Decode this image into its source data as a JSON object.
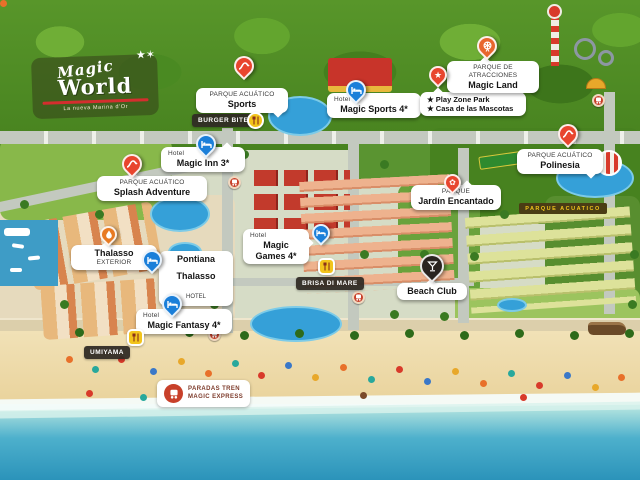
{
  "logo": {
    "name_top": "Magic",
    "name_bottom": "World",
    "tagline": "La nueva Marina d'Or",
    "stars": "★✶"
  },
  "markers": {
    "sports": {
      "category": "PARQUE ACUÁTICO",
      "name": "Sports"
    },
    "magic_sports": {
      "category": "Hotel",
      "name": "Magic Sports 4*"
    },
    "play_zone": {
      "line1": "★ Play Zone Park",
      "line2": "★ Casa de las Mascotas"
    },
    "magic_land": {
      "category": "PARQUE DE ATRACCIONES",
      "name": "Magic Land"
    },
    "burger_bites": {
      "name": "BURGER BITES"
    },
    "magic_inn": {
      "category": "Hotel",
      "name": "Magic Inn 3*"
    },
    "splash_adventure": {
      "category": "PARQUE ACUÁTICO",
      "name": "Splash Adventure"
    },
    "polinesia": {
      "category": "PARQUE ACUÁTICO",
      "name": "Polinesia"
    },
    "jardin_encantado": {
      "category": "PARQUE",
      "name": "Jardín Encantado"
    },
    "magic_games": {
      "category": "Hotel",
      "name": "Magic Games 4*"
    },
    "thalasso_exterior": {
      "name": "Thalasso",
      "sub": "EXTERIOR"
    },
    "pontiana": {
      "name": "Pontiana",
      "name2": "Thalasso",
      "suffix": "HOTEL"
    },
    "brisa_di_mare": {
      "name": "BRISA DI MARE"
    },
    "beach_club": {
      "name": "Beach Club"
    },
    "magic_fantasy": {
      "category": "Hotel",
      "name": "Magic Fantasy 4*"
    },
    "umiyama": {
      "name": "UMIYAMA"
    },
    "paradas_tren": {
      "line1": "PARADAS TREN",
      "line2": "MAGIC EXPRESS"
    }
  },
  "map_art": {
    "parque_acuatico_sign": "PARQUE ACUATICO"
  },
  "colors": {
    "hotel_pin": "#1b7fd9",
    "waterpark_pin": "#e8452e",
    "attraction_pin": "#e8662e",
    "beach_club_pin": "#2a2420",
    "train_stop": "#c8402a",
    "food_icon": "#f2c41c",
    "badge_bg": "#3a332e",
    "sea": "#2b93ba",
    "sand": "#f2e3ba",
    "forest": "#47821f"
  }
}
